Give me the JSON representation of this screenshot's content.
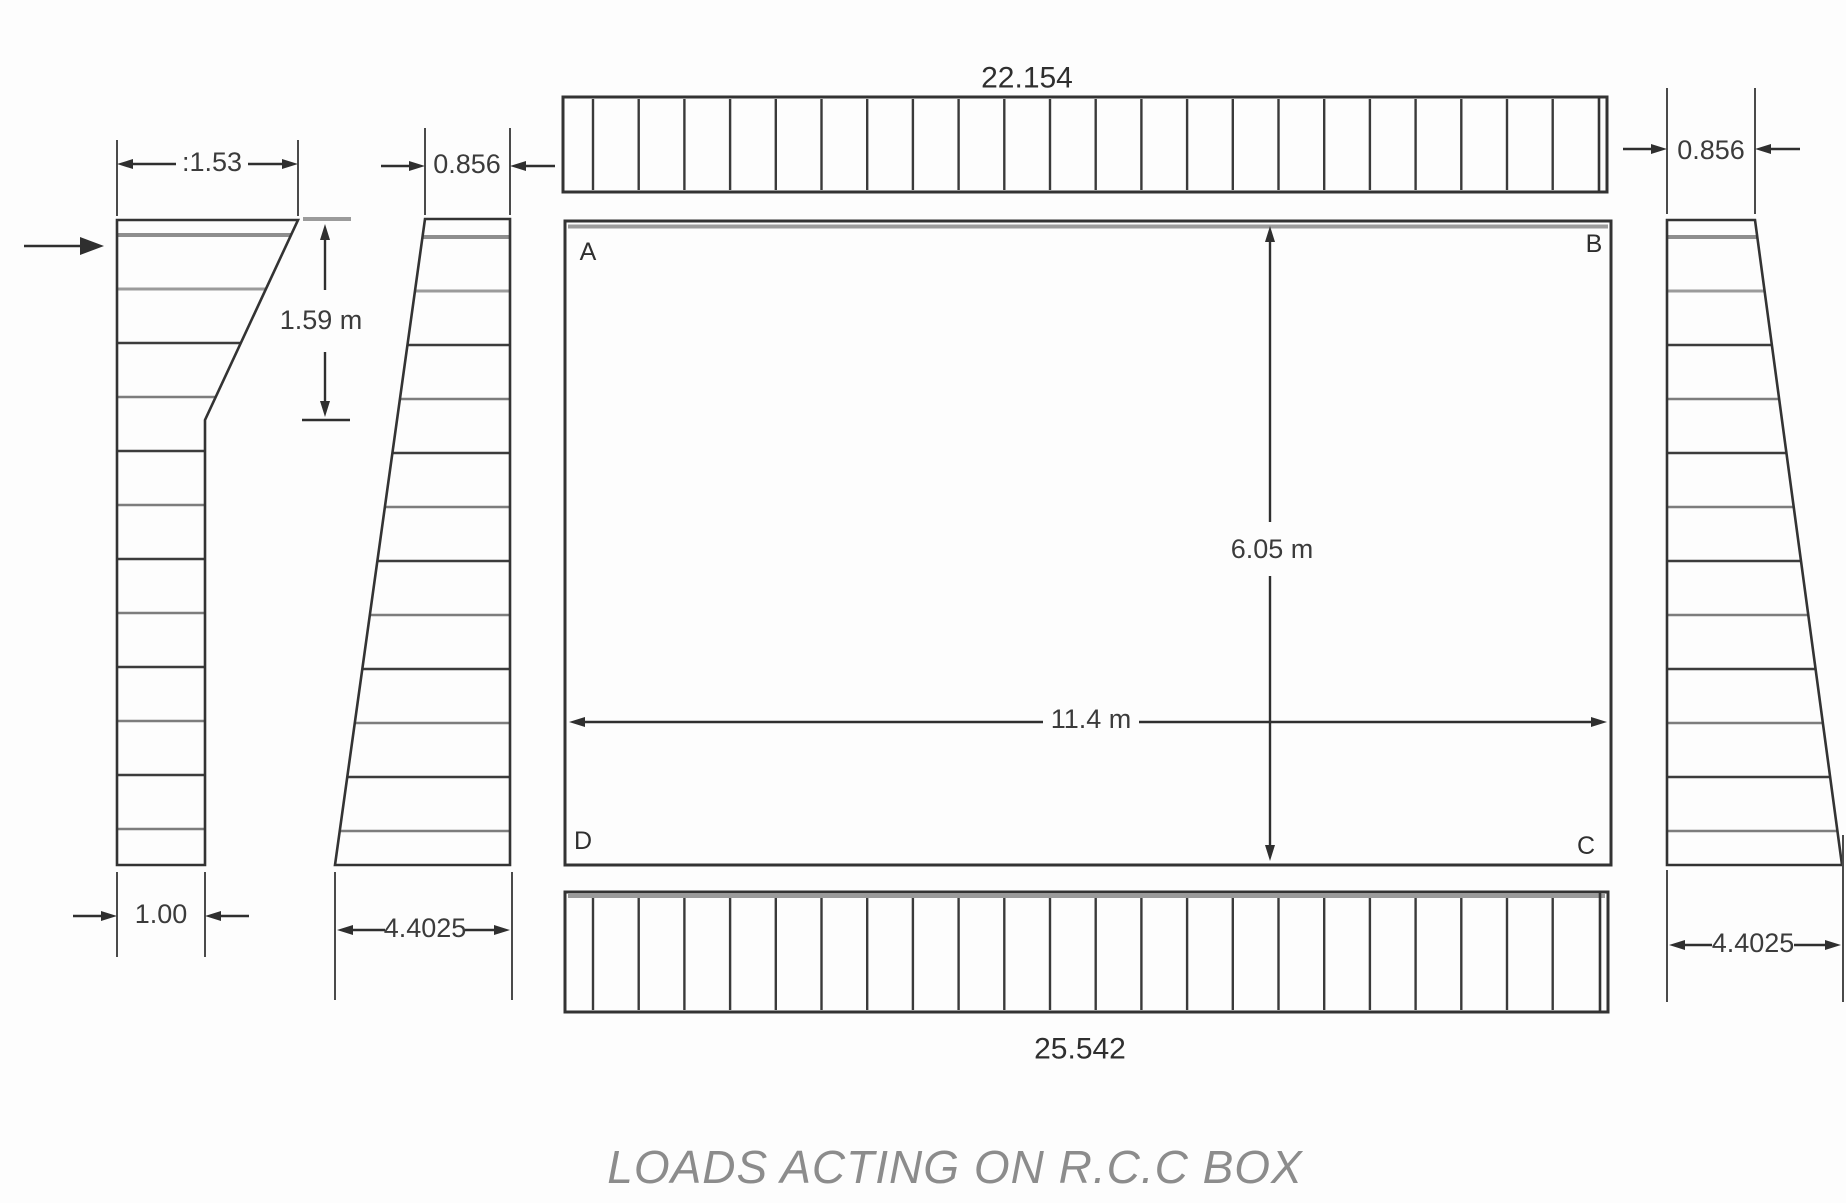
{
  "figure": {
    "caption": "LOADS ACTING ON R.C.C BOX"
  },
  "box": {
    "corners": {
      "a": "A",
      "b": "B",
      "c": "C",
      "d": "D"
    },
    "height_dim": "6.05 m",
    "width_dim": "11.4 m"
  },
  "loads": {
    "top_udl": {
      "value": "22.154"
    },
    "bottom_udl": {
      "value": "25.542"
    },
    "left_surcharge": {
      "top_width": ":1.53",
      "depth": "1.59 m",
      "bottom_width": "1.00"
    },
    "left_earth": {
      "top_width": "0.856",
      "bottom_width": "4.4025"
    },
    "right_earth": {
      "top_width": "0.856",
      "bottom_width": "4.4025"
    }
  }
}
